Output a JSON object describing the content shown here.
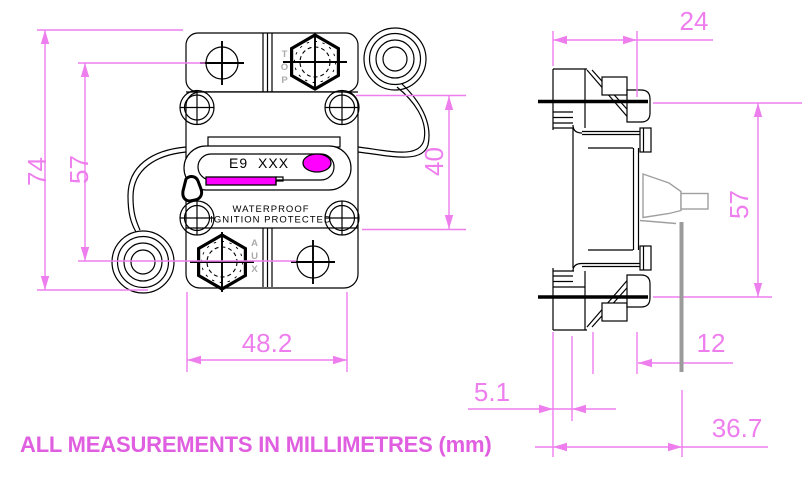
{
  "footer": {
    "note": "ALL MEASUREMENTS IN MILLIMETRES (mm)"
  },
  "front_view": {
    "device_label": "E9 XXX",
    "marking_line1": "WATERPROOF",
    "marking_line2": "IGNITION PROTECTED",
    "orientation_marking_top": "TOP",
    "orientation_marking_aux": "AUX",
    "dims": {
      "overall_height": "74",
      "hole_span": "57",
      "body_height": "40",
      "width": "48.2"
    }
  },
  "side_view": {
    "dims": {
      "top_depth": "24",
      "stud_span": "57",
      "panel_offset": "12",
      "bracket_thickness": "5.1",
      "overall_depth": "36.7"
    }
  },
  "colors": {
    "dimension_magenta": "#ee7eee",
    "note_magenta": "#e05fe0",
    "accent_fill": "#ff00ff",
    "outline_black": "#000000",
    "grey_part": "#a0a0a0"
  }
}
